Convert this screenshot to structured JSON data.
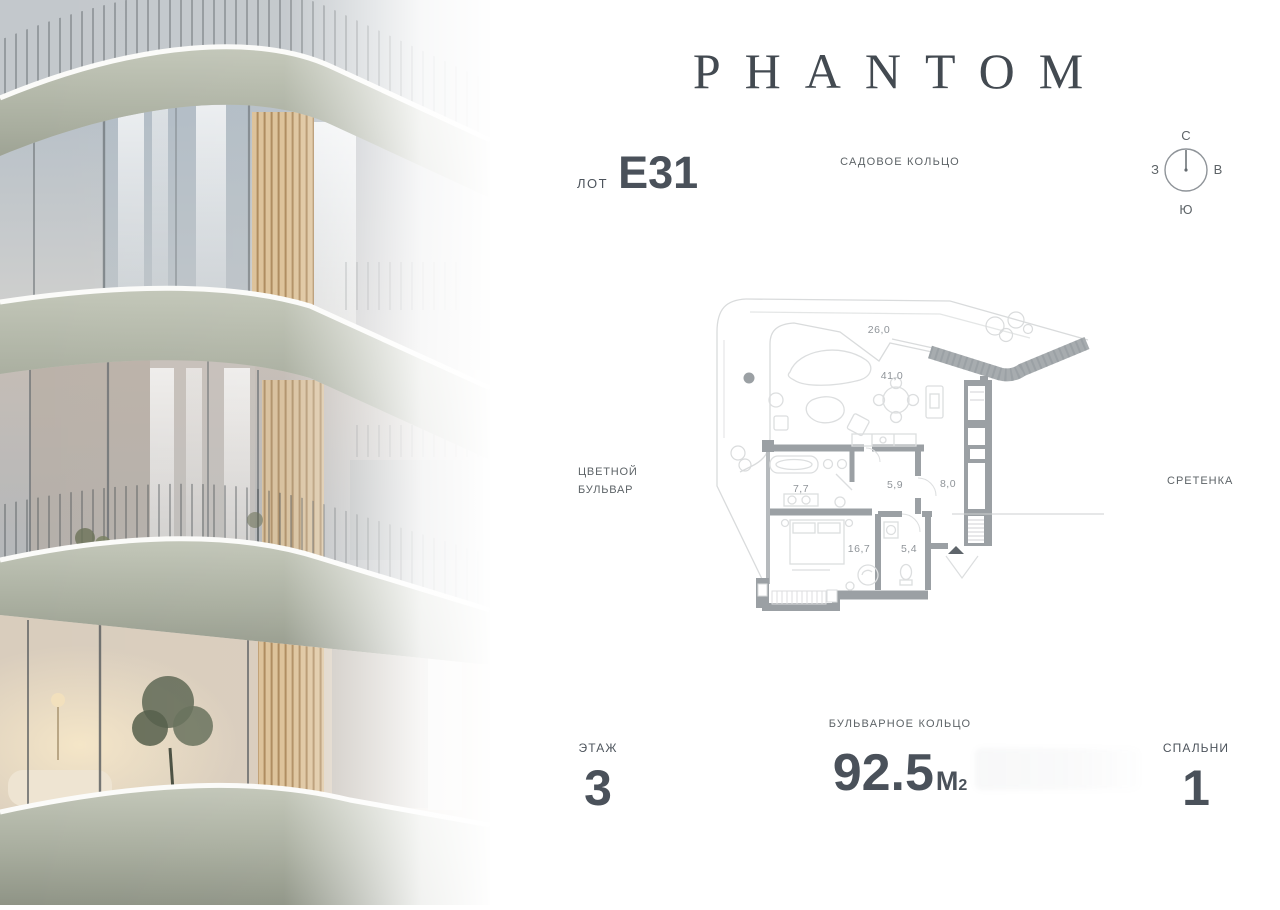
{
  "brand": {
    "logo": "PHANTOM"
  },
  "lot": {
    "label": "ЛОТ",
    "value": "Е31"
  },
  "streets": {
    "top": "САДОВОЕ КОЛЬЦО",
    "left_line1": "ЦВЕТНОЙ",
    "left_line2": "БУЛЬВАР",
    "right": "СРЕТЕНКА",
    "bottom": "БУЛЬВАРНОЕ КОЛЬЦО"
  },
  "compass": {
    "north": "С",
    "east": "В",
    "south": "Ю",
    "west": "З"
  },
  "floorplan": {
    "rooms": [
      {
        "name": "terrace",
        "area": "26,0"
      },
      {
        "name": "living",
        "area": "41,0"
      },
      {
        "name": "bathroom",
        "area": "7,7"
      },
      {
        "name": "hall",
        "area": "5,9"
      },
      {
        "name": "corridor",
        "area": "8,0"
      },
      {
        "name": "bedroom",
        "area": "16,7"
      },
      {
        "name": "wc",
        "area": "5,4"
      }
    ]
  },
  "stats": {
    "floor_label": "ЭТАЖ",
    "floor_value": "3",
    "area_value": "92.5",
    "area_unit": "М",
    "area_unit_sup": "2",
    "bedrooms_label": "СПАЛЬНИ",
    "bedrooms_value": "1"
  },
  "colors": {
    "ink": "#4a515a",
    "label_gray": "#5d6367",
    "plan_wall": "#9ba0a4",
    "plan_light": "#d9dbdc",
    "facade_sage": "#a8ad9e",
    "wood": "#dcc198"
  }
}
